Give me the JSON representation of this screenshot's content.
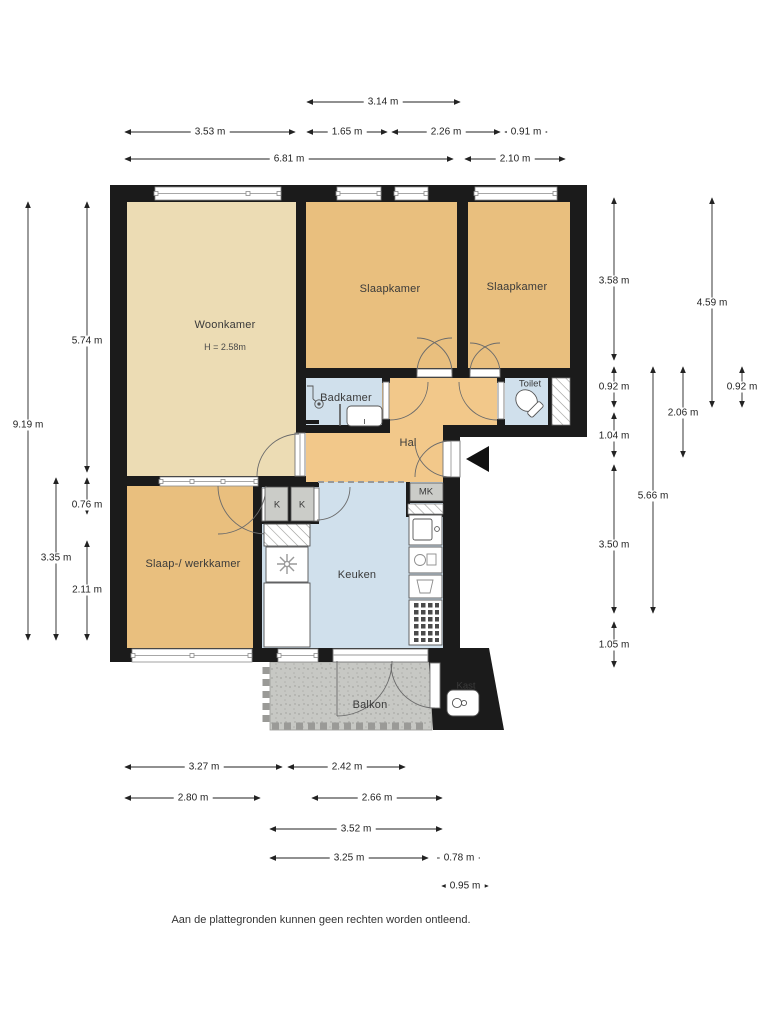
{
  "plan": {
    "rooms": {
      "woonkamer": "Woonkamer",
      "woonkamer_height": "H = 2.58m",
      "slaapkamer_top": "Slaapkamer",
      "slaapkamer_right": "Slaapkamer",
      "badkamer": "Badkamer",
      "toilet": "Toilet",
      "hal": "Hal",
      "slaap_werkkamer": "Slaap-/ werkkamer",
      "keuken": "Keuken",
      "balkon": "Balkon",
      "kast": "Kast",
      "mk": "MK",
      "k1": "K",
      "k2": "K"
    },
    "dimensions": {
      "top": {
        "d314": "3.14 m",
        "d353": "3.53 m",
        "d165": "1.65 m",
        "d226": "2.26 m",
        "d091": "0.91 m",
        "d681": "6.81 m",
        "d210": "2.10 m"
      },
      "left": {
        "d919": "9.19 m",
        "d574": "5.74 m",
        "d076": "0.76 m",
        "d335": "3.35 m",
        "d211": "2.11 m"
      },
      "right": {
        "d358": "3.58 m",
        "d459": "4.59 m",
        "d092a": "0.92 m",
        "d092b": "0.92 m",
        "d206": "2.06 m",
        "d104": "1.04 m",
        "d566": "5.66 m",
        "d350": "3.50 m",
        "d105": "1.05 m"
      },
      "bottom": {
        "d327": "3.27 m",
        "d242": "2.42 m",
        "d280": "2.80 m",
        "d266": "2.66 m",
        "d352": "3.52 m",
        "d325": "3.25 m",
        "d078": "0.78 m",
        "d095": "0.95 m"
      }
    },
    "colors": {
      "wall": "#1b1b1b",
      "room_light": "#ecdcb4",
      "room_tan": "#e9bf7e",
      "hal_orange": "#f2c88a",
      "wet_blue": "#d0e0ec",
      "closet_gray": "#cbccc8",
      "balkon_gray": "#c7c8c4"
    },
    "footer": "Aan de plattegronden kunnen geen rechten worden ontleend."
  }
}
